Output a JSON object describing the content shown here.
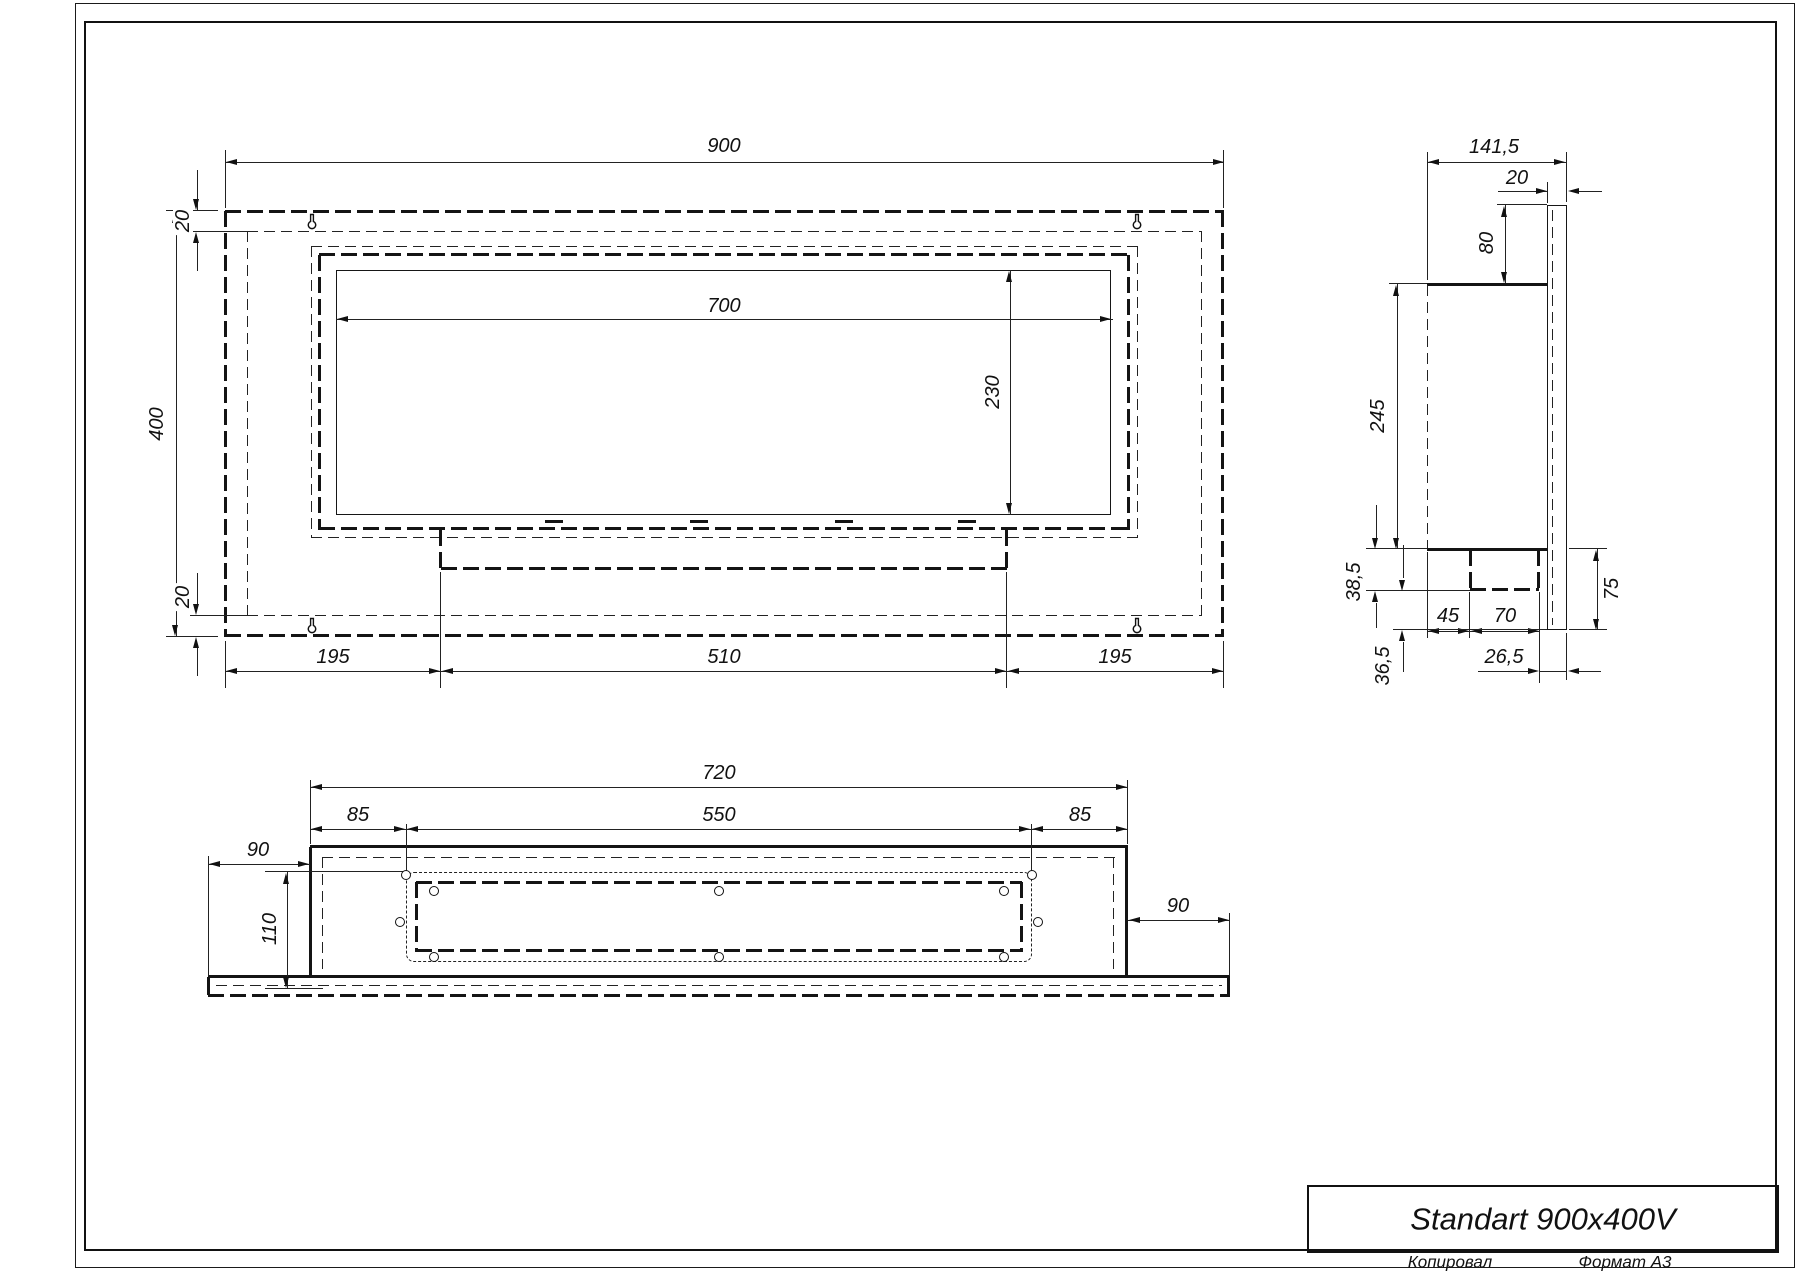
{
  "front": {
    "width": "900",
    "height": "400",
    "offset_top": "20",
    "offset_bottom": "20",
    "opening_width": "700",
    "opening_height": "230",
    "base_left": "195",
    "base_center": "510",
    "base_right": "195"
  },
  "side": {
    "depth": "141,5",
    "panel_thickness": "20",
    "top_offset": "80",
    "box_height": "245",
    "tray_height": "38,5",
    "seg_left": "45",
    "seg_right": "70",
    "back_offset": "26,5",
    "bottom_offset": "36,5",
    "panel_below": "75"
  },
  "bottom": {
    "body_width": "720",
    "margin_left": "85",
    "opening_width": "550",
    "margin_right": "85",
    "overhang_left": "90",
    "overhang_right": "90",
    "depth": "110"
  },
  "title_block": {
    "title": "Standart 900x400V",
    "copied_label": "Копировал",
    "format_label": "Формат А3"
  }
}
